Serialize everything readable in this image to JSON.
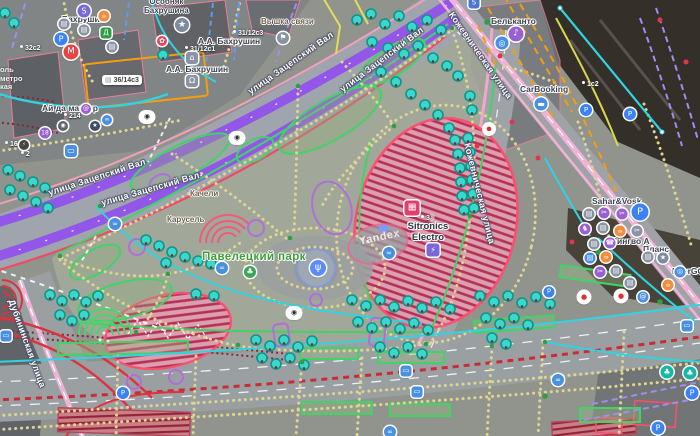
{
  "map": {
    "watermark": "Yandex",
    "park": "Павелецкий парк",
    "streets": {
      "zatsepsky": "улица Зацепский Вал",
      "kozhevnicheskaya": "Кожевническая улица",
      "dubininskaya": "Дубининская улица"
    },
    "features": {
      "tower": "Вышка связи",
      "swings": "Качели",
      "carousel": "Карусель"
    },
    "pois": {
      "metro_station": "Бахрушин",
      "mansion": [
        "Особняк",
        "Бахрушина"
      ],
      "museum_top": "А.А. Бахрушин",
      "museum": "А.А. Бахрушин",
      "master": "Ай да мастер",
      "belcanto": "Бельканто",
      "carbooking": "CarBooking",
      "sahar": "Sahar&Vosk",
      "lingvo": "Лингво А",
      "plans": "Планс",
      "energo": "EnerGO",
      "sitronics": [
        "Sitronics",
        "Electro"
      ]
    },
    "addresses": {
      "n32": "32с2",
      "n31c1": "31/12с1",
      "n31c3": "31/12с3",
      "n36": "36/14с3",
      "n1c2": "1с2",
      "n16": "16",
      "n2": "2",
      "n214": "214",
      "n3": "3"
    },
    "cutoff": [
      "оль",
      "метро",
      "кая"
    ],
    "icons": {
      "metro": "М",
      "parking": "P",
      "bank": "S",
      "star": "★",
      "bell": "Ω",
      "museum": "⌂",
      "flag": "⚑",
      "cafe": "☕",
      "briefcase": "▤",
      "store": "Д",
      "bus": "▭",
      "bike": "∞",
      "fountain": "ψ",
      "charge": "⚡",
      "stage": "▦",
      "music": "♪",
      "target": "◎",
      "car": "▬",
      "scissors": "✂",
      "horse": "♞",
      "at": "@",
      "camera": "◉",
      "speedcam": "●",
      "age": "18",
      "tree": "♣",
      "phone": "☎",
      "flower": "✿",
      "moon": "☽"
    },
    "colors": {
      "road_primary": "#9257e8",
      "road_pink": "#f2b2d6",
      "tram_red": "#cb2b36",
      "tree_fill": "#3bd6cc",
      "path_dots": "#ded592",
      "lawn_green": "#3fd465",
      "hatch_red": "#b53054",
      "poi_blue": "#3b82f6",
      "metro_red": "#e64545",
      "cyan_line": "#2fd3e2",
      "orange_line": "#f59e0b"
    }
  }
}
